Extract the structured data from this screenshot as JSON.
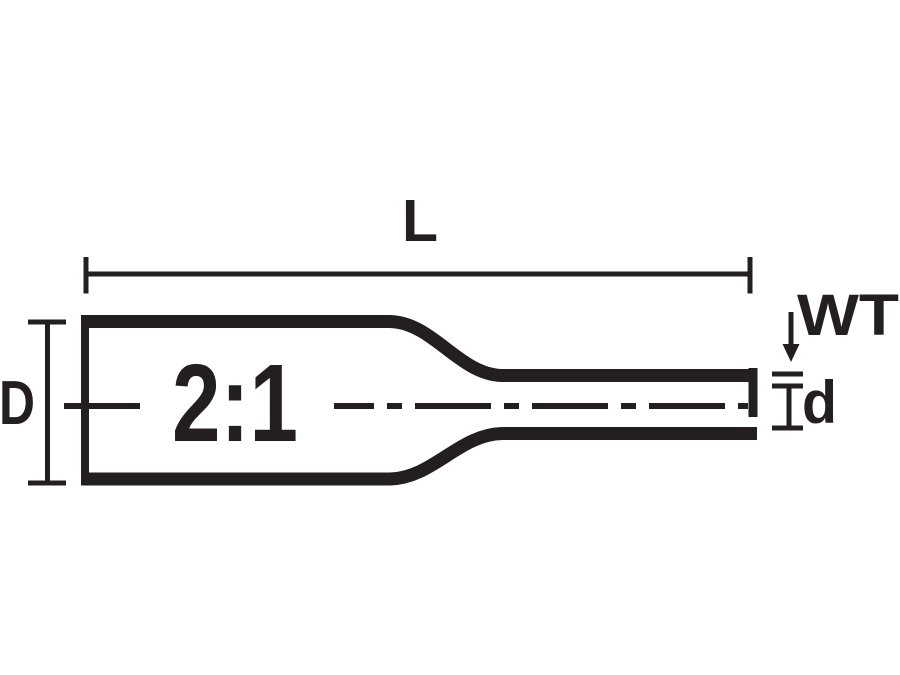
{
  "figure": {
    "description": "Technical dimension diagram of 2:1 heat-shrinkable tubing, shown before recovery tapering to recovered diameter",
    "colors": {
      "ink": "#231f20",
      "background": "#ffffff"
    },
    "labels": {
      "length": "L",
      "expanded_diameter": "D",
      "wall_thickness": "WT",
      "recovered_diameter": "d",
      "shrink_ratio": "2:1"
    }
  }
}
